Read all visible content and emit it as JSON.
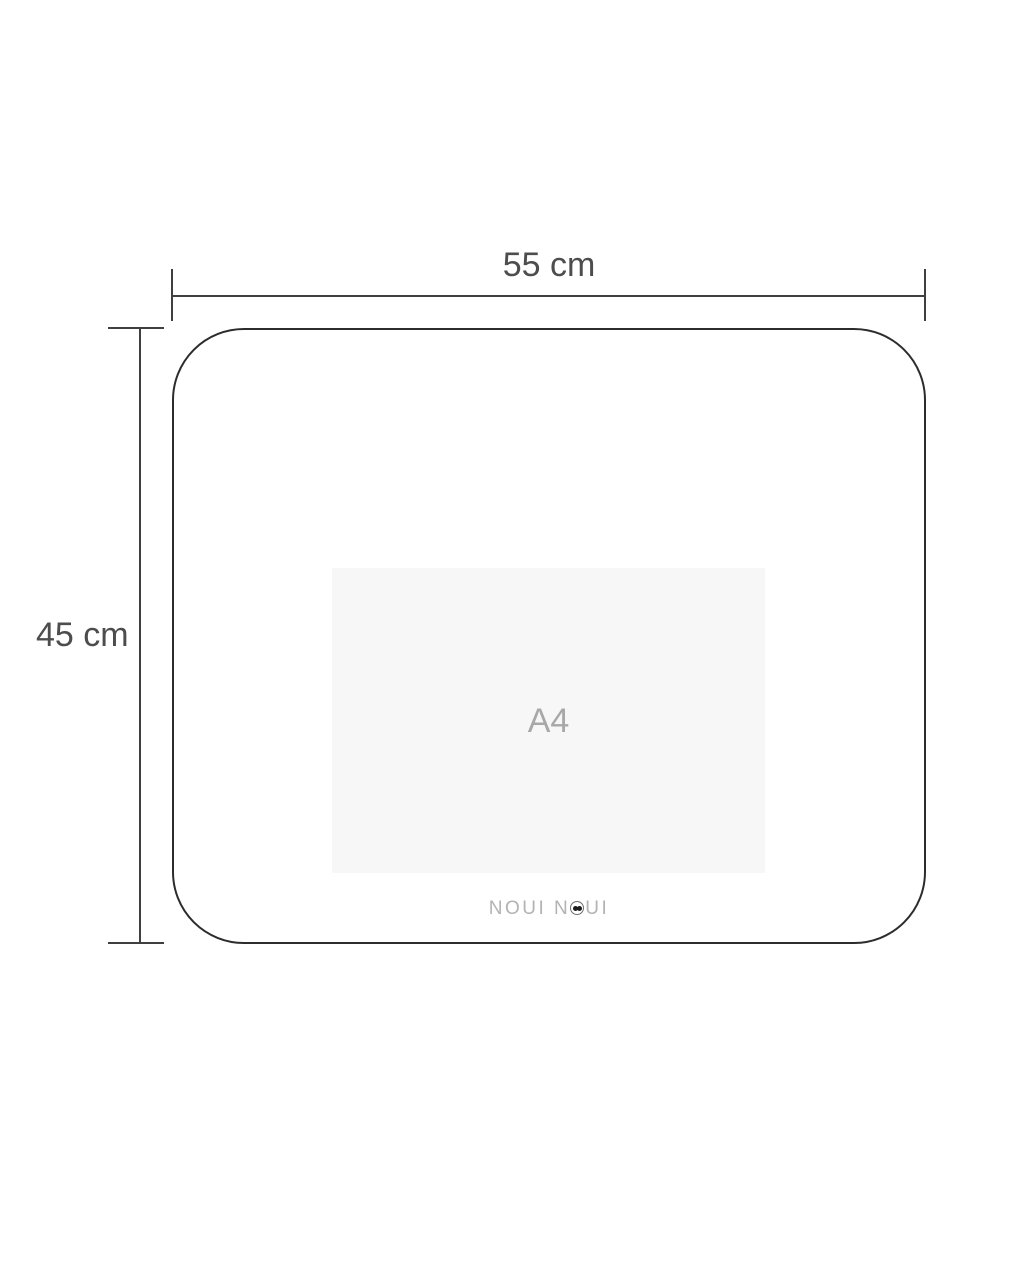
{
  "diagram": {
    "title": "placemat-dimension-diagram",
    "width_dimension": {
      "label": "55 cm"
    },
    "height_dimension": {
      "label": "45 cm"
    },
    "size_reference": {
      "label": "A4"
    },
    "brand": {
      "name": "NOUI NOUI",
      "text_before_icon": "NOUI N",
      "text_after_icon": "UI"
    },
    "colors": {
      "background": "#ffffff",
      "dimension_line": "#3f3f3f",
      "dimension_text": "#4d4d4d",
      "placemat_outline": "#2c2c2c",
      "a4_fill": "#f7f7f7",
      "a4_text": "#a8a8a8",
      "brand_text": "#b3b3b3",
      "brand_eye": "#1c1c1c"
    }
  }
}
